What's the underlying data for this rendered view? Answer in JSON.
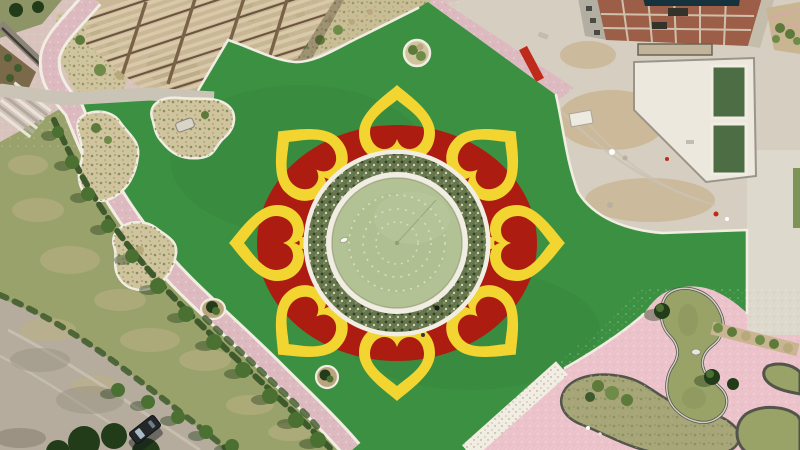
{
  "scene": {
    "title": "Aerial drone view of a park with a flower-shaped plaza",
    "description": "Top-down aerial photo: a circular pond ringed by shrubs sits at the center of a red annulus decorated with eight hollow yellow heart-shaped petals on a bright green lawn; construction site and rooftop at top right, pink paved plaza with organic ponds at bottom right, curved pink footpaths, sand planting islands, a timber pergola at top left, a dirt road with a parked dark vehicle at bottom left.",
    "flower": {
      "petal_count": 8,
      "petal_shape": "hollow heart, tip pointing outward",
      "fountain_dotted_rings": 3
    },
    "counts": {
      "sand_islands": 3,
      "round_planters": 3,
      "pool_basins": 2,
      "ponds_bottom_right": 3,
      "vehicles": 1
    }
  },
  "colors": {
    "lawn": "#3B9041",
    "flowerRed": "#AC1C10",
    "petalYellow": "#F2D531",
    "pondWater": "#B3C295",
    "pondWaterEdge": "#8FA077",
    "shrubRing": "#67774D",
    "curbWhite": "#F1EDE2",
    "pathPink": "#DCBABF",
    "plazaPink": "#ECC3CB",
    "grassOlive": "#99A26B",
    "grassDry": "#BCB283",
    "roadGray": "#B5AC9D",
    "concrete": "#D6CEC0",
    "concreteLight": "#DED9CD",
    "dirtTan": "#C9B592",
    "roofBrick": "#9D5E47",
    "roofGrid": "#CFC0AC",
    "roofTeal": "#16323C",
    "poolWater": "#4D6D45",
    "canalWater": "#99A368",
    "bedDry": "#A6A678",
    "stoneEdge": "#53544A",
    "sandBed": "#CFC49E",
    "sandTop": "#C9BD96",
    "bushGreen": "#5D7A3B",
    "hedgeGreen": "#3E5A2D",
    "treeGreen": "#4B7132",
    "treeDark": "#223C1A",
    "timber": "#D9C9A8",
    "timberShadow": "#6B5340",
    "pavingGray": "#CAC4B6",
    "wallGray": "#8A8578",
    "vehicleDark": "#24272A",
    "gardenBase": "#D9C3BD",
    "bedBrown": "#6B5236",
    "redStrip": "#BF2B1A"
  }
}
